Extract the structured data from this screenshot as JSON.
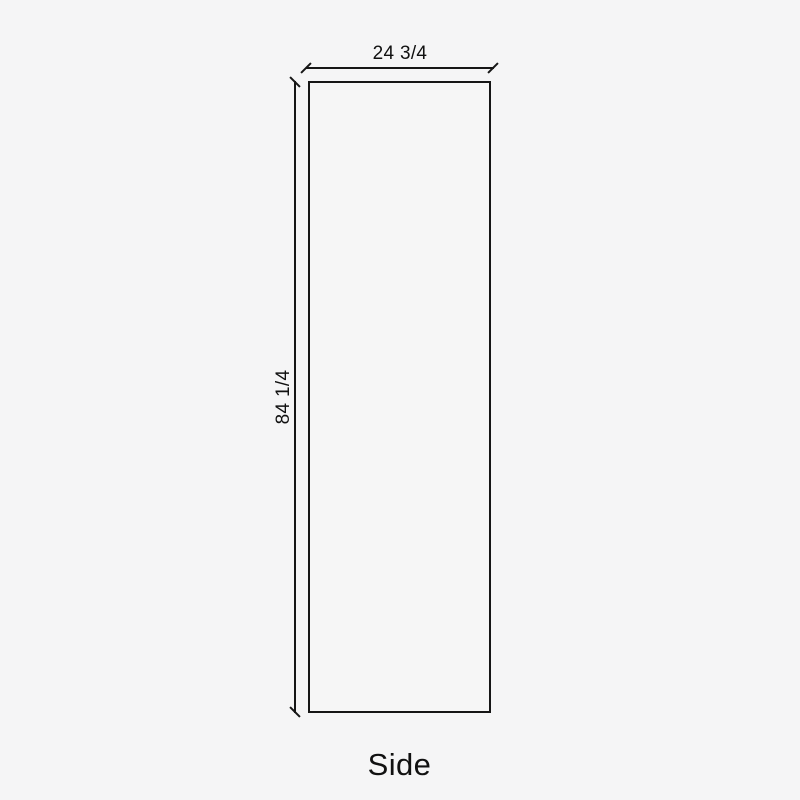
{
  "colors": {
    "background": "#f5f5f6",
    "line": "#161616",
    "panel-fill": "#f6f6f6",
    "text": "#111111"
  },
  "drawing": {
    "caption": "Side",
    "dimensions": {
      "width": {
        "label": "24 3/4"
      },
      "height": {
        "label": "84 1/4"
      }
    }
  }
}
